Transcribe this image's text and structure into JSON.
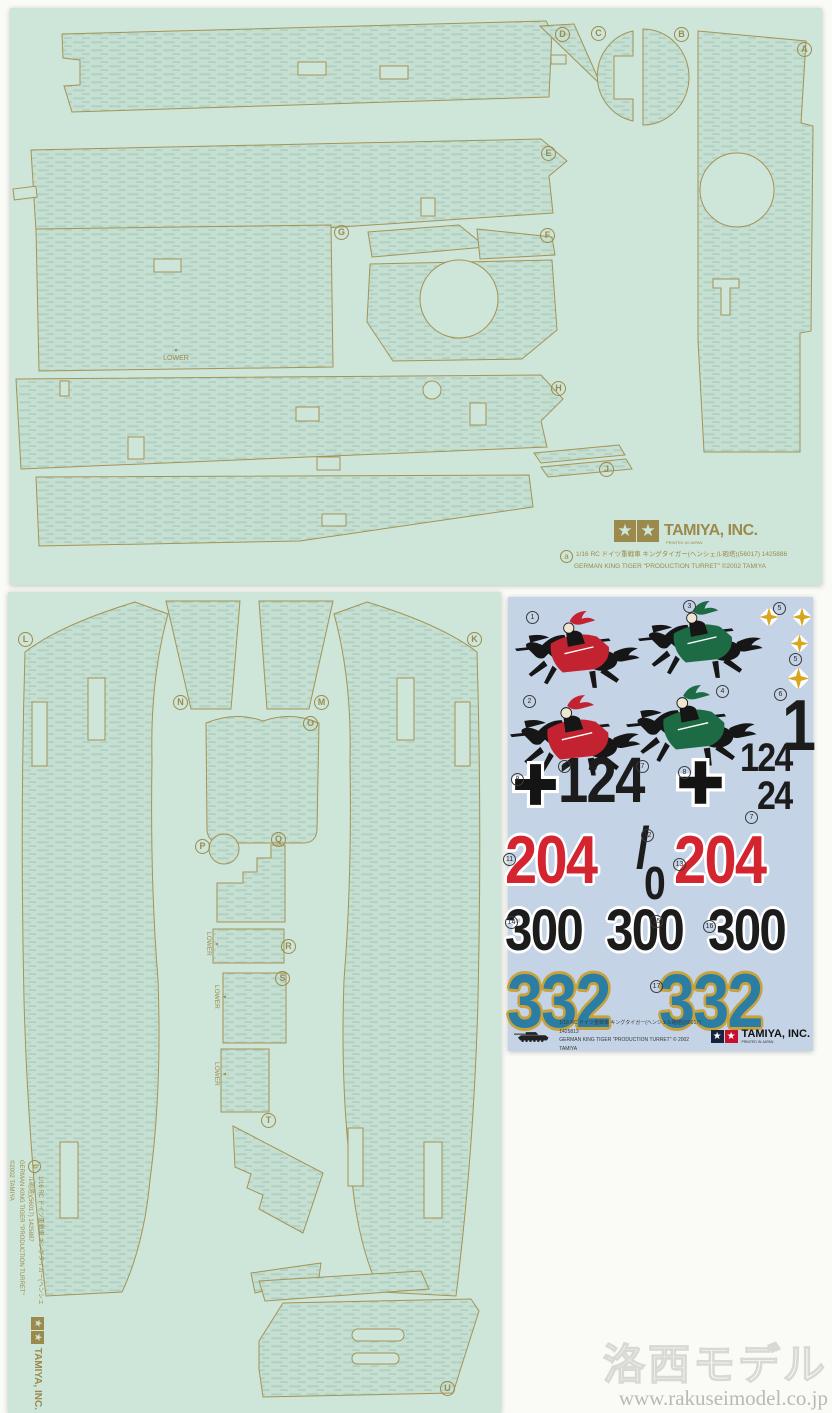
{
  "brand": {
    "name": "TAMIYA, INC.",
    "sub": "PRINTED IN JAPAN"
  },
  "sheet_a": {
    "id_label": "a",
    "info_jp": "1/16 RC ドイツ重戦車 キングタイガー(ヘンシェル砲塔)(56017) 1425886",
    "info_en": "GERMAN KING TIGER \"PRODUCTION TURRET\" ©2002 TAMIYA",
    "lower": "LOWER",
    "lower_arrow": "▼",
    "parts": [
      "D",
      "C",
      "B",
      "A",
      "E",
      "G",
      "F",
      "H",
      "J"
    ]
  },
  "sheet_b": {
    "id_label": "b",
    "info_jp": "1/16 RC ドイツ重戦車 キングタイガー(ヘンシェル砲塔)(56017) 1425887",
    "info_en": "GERMAN KING TIGER \"PRODUCTION TURRET\" ©2002 TAMIYA",
    "lower": "LOWER",
    "lower_arrow": "▼",
    "parts": [
      "L",
      "K",
      "N",
      "M",
      "O",
      "P",
      "Q",
      "R",
      "S",
      "T",
      "U"
    ]
  },
  "decal": {
    "info_jp": "1/16 RC ドイツ重戦車 キングタイガー(ヘンシェル砲塔)(56017) 1425813",
    "info_en": "GERMAN KING TIGER \"PRODUCTION TURRET\" © 2002 TAMIYA",
    "numbers": {
      "one": "1",
      "n124": "124",
      "n24": "24",
      "n204": "204",
      "slash": "/",
      "zero": "0",
      "n300": "300",
      "n332": "332"
    },
    "circled": [
      "1",
      "3",
      "5",
      "2",
      "4",
      "5",
      "6",
      "8",
      "9",
      "7",
      "8",
      "7",
      "11",
      "12",
      "13",
      "14",
      "15",
      "16",
      "17"
    ]
  },
  "watermark": {
    "title": "洛西モデル",
    "url": "www.rakuseimodel.co.jp"
  },
  "colors": {
    "sheet-green": "#cde6d9",
    "piece-green": "#c5dfd2",
    "zim-line": "#b0d0c1",
    "outline": "#a59354",
    "gold-print": "#9b8a4b",
    "decal-bg": "#c4d3e6",
    "knight-red": "#c32331",
    "knight-green": "#1d6b45",
    "num-black": "#1c1c1c",
    "num-red": "#d42430",
    "num-teal": "#2b7da3",
    "num-gold": "#c8a23c",
    "cross-gold": "#d7a51e"
  }
}
